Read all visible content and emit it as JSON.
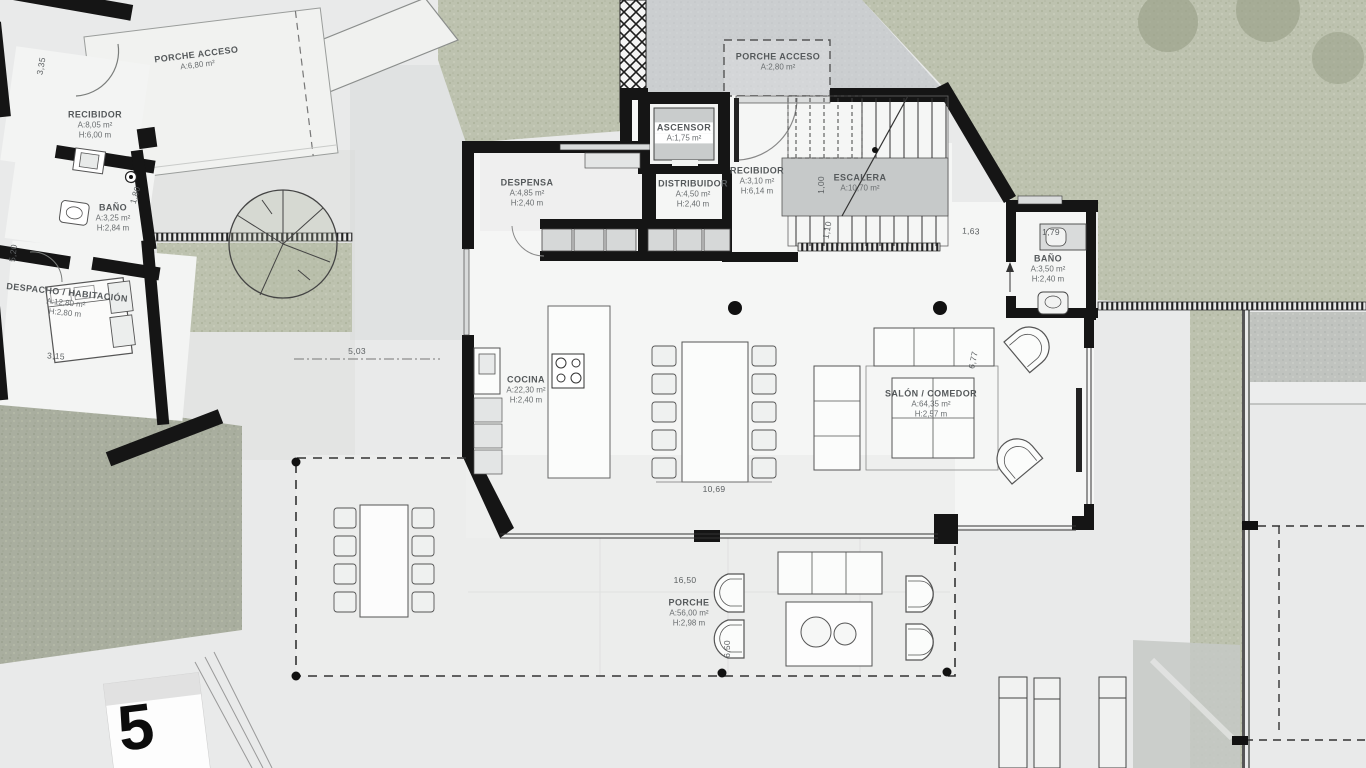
{
  "sheet": {
    "number": "5"
  },
  "rooms": {
    "porche_acceso_left": {
      "name": "PORCHE ACCESO",
      "area": "A:6,80 m²"
    },
    "recibidor_left": {
      "name": "RECIBIDOR",
      "area": "A:8,05 m²",
      "height": "H:6,00 m"
    },
    "bano_left": {
      "name": "BAÑO",
      "area": "A:3,25 m²",
      "height": "H:2,84 m"
    },
    "despacho": {
      "name": "DESPACHO / HABITACIÓN",
      "area": "A:12,80 m²",
      "height": "H:2,80 m"
    },
    "porche_acceso_top": {
      "name": "PORCHE ACCESO",
      "area": "A:2,80 m²"
    },
    "ascensor": {
      "name": "ASCENSOR",
      "area": "A:1,75 m²"
    },
    "despensa": {
      "name": "DESPENSA",
      "area": "A:4,85 m²",
      "height": "H:2,40 m"
    },
    "distribuidor": {
      "name": "DISTRIBUIDOR",
      "area": "A:4,50 m²",
      "height": "H:2,40 m"
    },
    "recibidor_main": {
      "name": "RECIBIDOR",
      "area": "A:3,10 m²",
      "height": "H:6,14 m"
    },
    "escalera": {
      "name": "ESCALERA",
      "area": "A:10,70 m²"
    },
    "bano_right": {
      "name": "BAÑO",
      "area": "A:3,50 m²",
      "height": "H:2,40 m"
    },
    "cocina": {
      "name": "COCINA",
      "area": "A:22,30 m²",
      "height": "H:2,40 m"
    },
    "salon": {
      "name": "SALÓN / COMEDOR",
      "area": "A:64,35 m²",
      "height": "H:2,57 m"
    },
    "porche": {
      "name": "PORCHE",
      "area": "A:56,00 m²",
      "height": "H:2,98 m"
    }
  },
  "dimensions": {
    "d335": "3,35",
    "d520": "5,20",
    "d180": "1,80",
    "d315": "3,15",
    "d503": "5,03",
    "d1069": "10,69",
    "d1650": "16,50",
    "d650": "6,50",
    "d677": "6,77",
    "d163": "1,63",
    "d179": "1,79",
    "d100": "1,00",
    "d110": "1,10"
  },
  "colors": {
    "wall": "#151515",
    "grass": "#bdc2af",
    "slope": "#a9ae9f",
    "paper": "#e9eaea",
    "room_fill": "#f5f6f5",
    "stair_landing": "#c6c9c9",
    "label_text": "#5a5e60"
  }
}
